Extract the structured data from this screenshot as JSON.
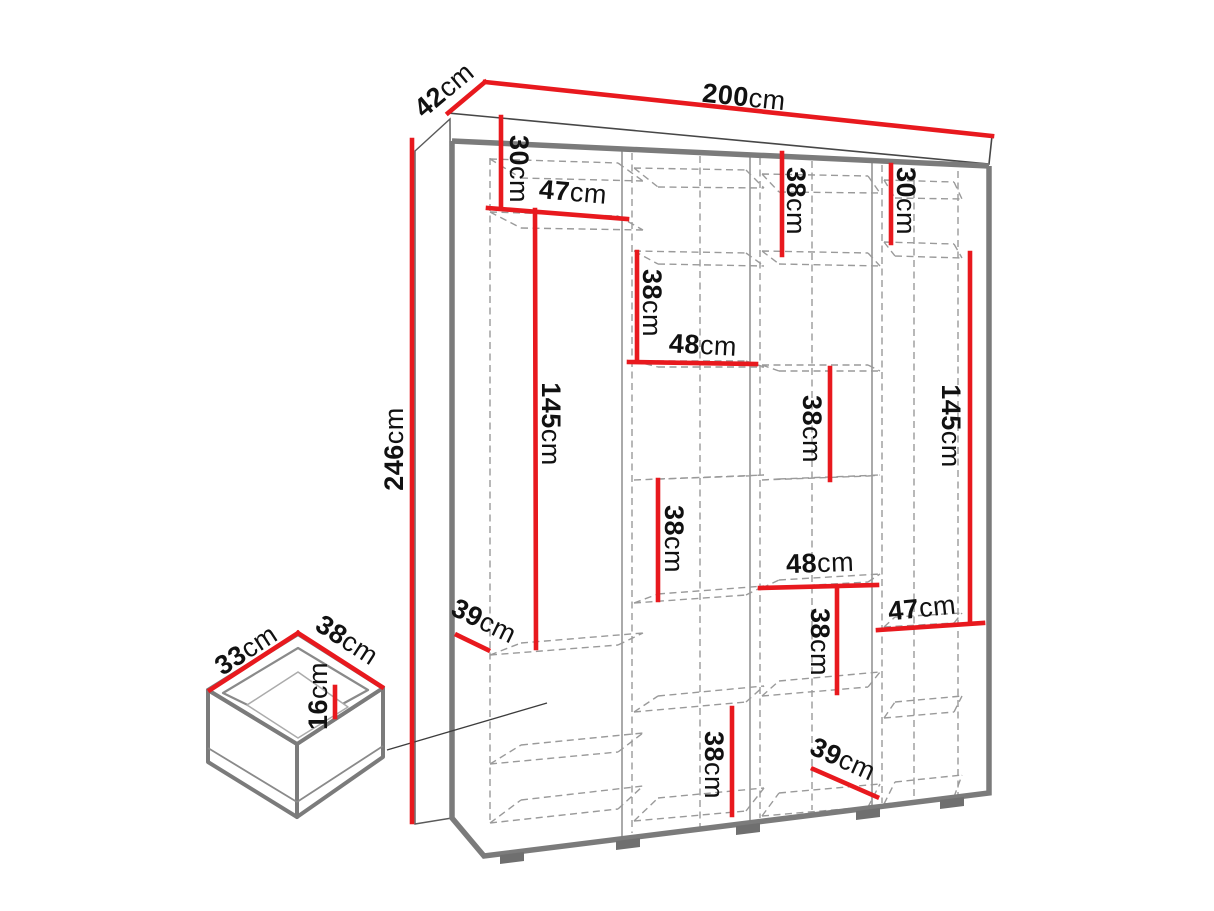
{
  "page": {
    "background": "#ffffff"
  },
  "colors": {
    "dimension_line": "#e8191e",
    "solid_edge": "#7b7b7b",
    "hidden_edge": "#9a9a9a",
    "label_text": "#111111"
  },
  "diagram": {
    "type": "furniture-dimension-diagram",
    "subject": "wardrobe with internal shelving and separate drawer detail",
    "unit": "cm",
    "overall": {
      "width": 200,
      "depth": 42,
      "height": 246
    },
    "drawer_box": {
      "depth": 33,
      "width": 38,
      "height": 16
    },
    "dimensions": [
      {
        "id": "wardrobe-depth",
        "value": "42",
        "unit": "cm",
        "line": [
          448,
          113,
          485,
          82
        ],
        "label_pos": [
          444,
          90
        ],
        "label_rotation": -40
      },
      {
        "id": "wardrobe-width",
        "value": "200",
        "unit": "cm",
        "line": [
          485,
          82,
          992,
          136
        ],
        "label_pos": [
          744,
          97
        ],
        "label_rotation": 6
      },
      {
        "id": "wardrobe-height",
        "value": "246",
        "unit": "cm",
        "line": [
          412,
          140,
          412,
          822
        ],
        "label_pos": [
          394,
          449
        ],
        "label_rotation": -90
      },
      {
        "id": "col1-top-height",
        "value": "30",
        "unit": "cm",
        "line": [
          501,
          117,
          501,
          207
        ],
        "label_pos": [
          519,
          169
        ],
        "label_rotation": 90
      },
      {
        "id": "col1-width",
        "value": "47",
        "unit": "cm",
        "line": [
          488,
          208,
          627,
          219
        ],
        "label_pos": [
          573,
          192
        ],
        "label_rotation": 5
      },
      {
        "id": "col3-top-height",
        "value": "38",
        "unit": "cm",
        "line": [
          782,
          153,
          782,
          255
        ],
        "label_pos": [
          796,
          201
        ],
        "label_rotation": 90
      },
      {
        "id": "col4-top-height",
        "value": "30",
        "unit": "cm",
        "line": [
          891,
          165,
          891,
          243
        ],
        "label_pos": [
          906,
          201
        ],
        "label_rotation": 90
      },
      {
        "id": "col2-upper-height",
        "value": "38",
        "unit": "cm",
        "line": [
          637,
          252,
          637,
          360
        ],
        "label_pos": [
          652,
          303
        ],
        "label_rotation": 90
      },
      {
        "id": "col2-width",
        "value": "48",
        "unit": "cm",
        "line": [
          629,
          362,
          756,
          364
        ],
        "label_pos": [
          703,
          345
        ],
        "label_rotation": 3
      },
      {
        "id": "col1-hanging-height",
        "value": "145",
        "unit": "cm",
        "line": [
          535,
          210,
          536,
          648
        ],
        "label_pos": [
          551,
          424
        ],
        "label_rotation": 90
      },
      {
        "id": "col3-mid-height",
        "value": "38",
        "unit": "cm",
        "line": [
          830,
          368,
          830,
          480
        ],
        "label_pos": [
          812,
          429
        ],
        "label_rotation": 90
      },
      {
        "id": "col4-hanging-height",
        "value": "145",
        "unit": "cm",
        "line": [
          970,
          253,
          970,
          622
        ],
        "label_pos": [
          951,
          426
        ],
        "label_rotation": 90
      },
      {
        "id": "col2-mid-height",
        "value": "38",
        "unit": "cm",
        "line": [
          658,
          480,
          658,
          600
        ],
        "label_pos": [
          674,
          539
        ],
        "label_rotation": 90
      },
      {
        "id": "col3-width",
        "value": "48",
        "unit": "cm",
        "line": [
          760,
          588,
          877,
          585
        ],
        "label_pos": [
          820,
          563
        ],
        "label_rotation": -2
      },
      {
        "id": "col4-width",
        "value": "47",
        "unit": "cm",
        "line": [
          878,
          630,
          983,
          623
        ],
        "label_pos": [
          922,
          608
        ],
        "label_rotation": -6
      },
      {
        "id": "col1-lower-height",
        "value": "39",
        "unit": "cm",
        "line": [
          457,
          635,
          488,
          650
        ],
        "label_pos": [
          484,
          621
        ],
        "label_rotation": 26
      },
      {
        "id": "col3-lower-height",
        "value": "38",
        "unit": "cm",
        "line": [
          837,
          590,
          837,
          693
        ],
        "label_pos": [
          820,
          642
        ],
        "label_rotation": 90
      },
      {
        "id": "col2-bottom-height",
        "value": "38",
        "unit": "cm",
        "line": [
          732,
          708,
          732,
          815
        ],
        "label_pos": [
          714,
          765
        ],
        "label_rotation": 90
      },
      {
        "id": "col3-bottom-height",
        "value": "39",
        "unit": "cm",
        "line": [
          813,
          769,
          877,
          797
        ],
        "label_pos": [
          843,
          759
        ],
        "label_rotation": 24
      },
      {
        "id": "drawer-depth",
        "value": "33",
        "unit": "cm",
        "line": [
          210,
          690,
          298,
          633
        ],
        "label_pos": [
          246,
          650
        ],
        "label_rotation": -33
      },
      {
        "id": "drawer-width",
        "value": "38",
        "unit": "cm",
        "line": [
          298,
          633,
          382,
          687
        ],
        "label_pos": [
          347,
          640
        ],
        "label_rotation": 33
      },
      {
        "id": "drawer-height",
        "value": "16",
        "unit": "cm",
        "line": [
          335,
          687,
          335,
          717
        ],
        "label_pos": [
          318,
          696
        ],
        "label_rotation": -90
      }
    ]
  }
}
